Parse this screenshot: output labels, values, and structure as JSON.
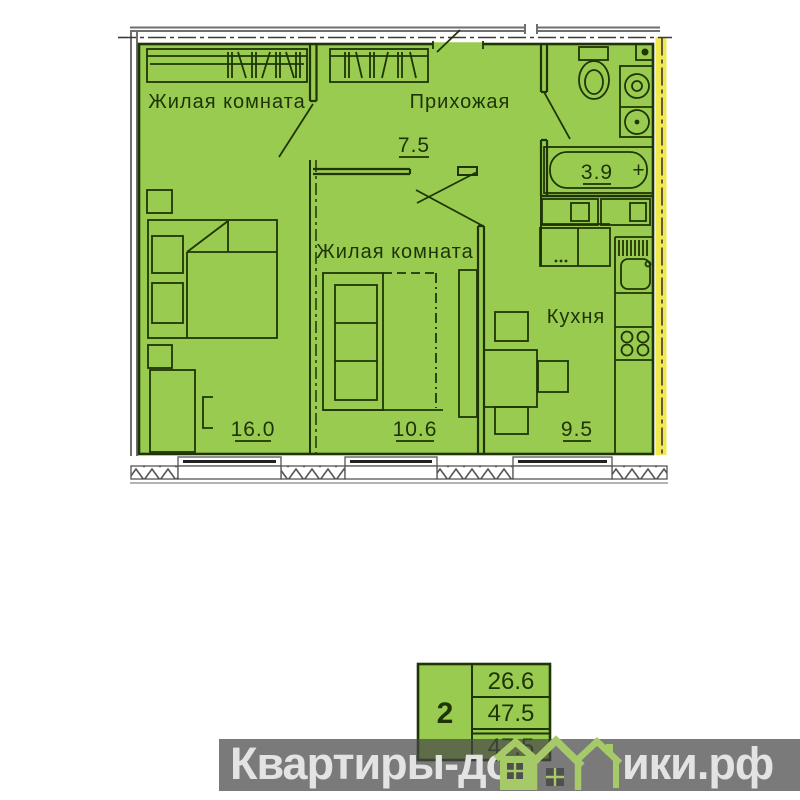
{
  "plan_type": "apartment-floor-plan",
  "rooms": {
    "living1": {
      "label": "Жилая комната",
      "area": "16.0"
    },
    "living2": {
      "label": "Жилая комната",
      "area": "10.6"
    },
    "hallway": {
      "label": "Прихожая",
      "area": "7.5"
    },
    "kitchen": {
      "label": "Кухня",
      "area": "9.5"
    },
    "bathroom": {
      "area": "3.9",
      "faucet_mark": "+"
    }
  },
  "info_table": {
    "rooms_count": "2",
    "rows": [
      "26.6",
      "47.5",
      "47.5"
    ]
  },
  "watermark": {
    "left": "Квартиры-до",
    "right": "ики.рф"
  },
  "colors": {
    "plan_fill": "#99cb50",
    "line_dark": "#1f3505",
    "outer_wall_gray": "#6f6f6f",
    "accent_wall_yellow": "#f1e94d",
    "watermark_bar": "#464646",
    "watermark_text": "#e3e3e3",
    "logo_green": "#a7ca68"
  }
}
